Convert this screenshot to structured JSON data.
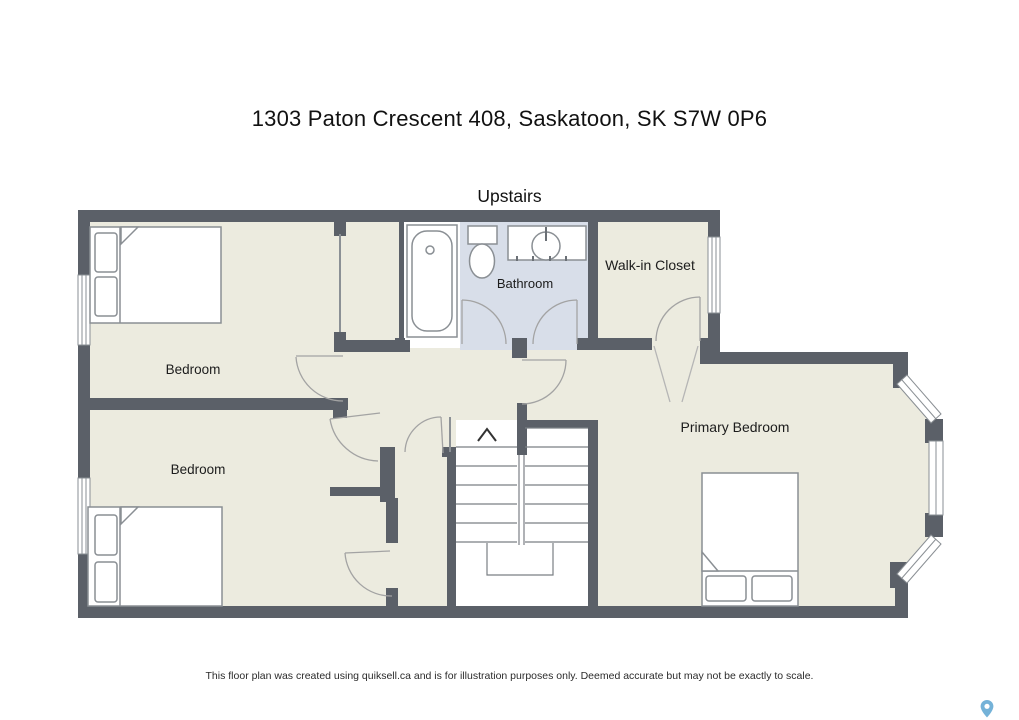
{
  "title": "1303 Paton Crescent 408, Saskatoon, SK S7W 0P6",
  "floor_label": "Upstairs",
  "rooms": {
    "bedroom_top": "Bedroom",
    "bedroom_bottom": "Bedroom",
    "bathroom": "Bathroom",
    "walk_in_closet": "Walk-in Closet",
    "primary_bedroom": "Primary Bedroom"
  },
  "disclaimer": "This floor plan was created using quiksell.ca and is for illustration purposes only. Deemed accurate but may not be exactly to scale.",
  "icons": {
    "location_pin": "location-pin",
    "stairs_up_arrow": "up-arrow"
  },
  "colors": {
    "wall": "#5b6068",
    "floor": "#ecebdf",
    "bathroom_floor": "#d8dee9",
    "furniture_outline": "#8a8f94",
    "door_arc": "#a3a3a3",
    "pin": "#74b2d8"
  }
}
